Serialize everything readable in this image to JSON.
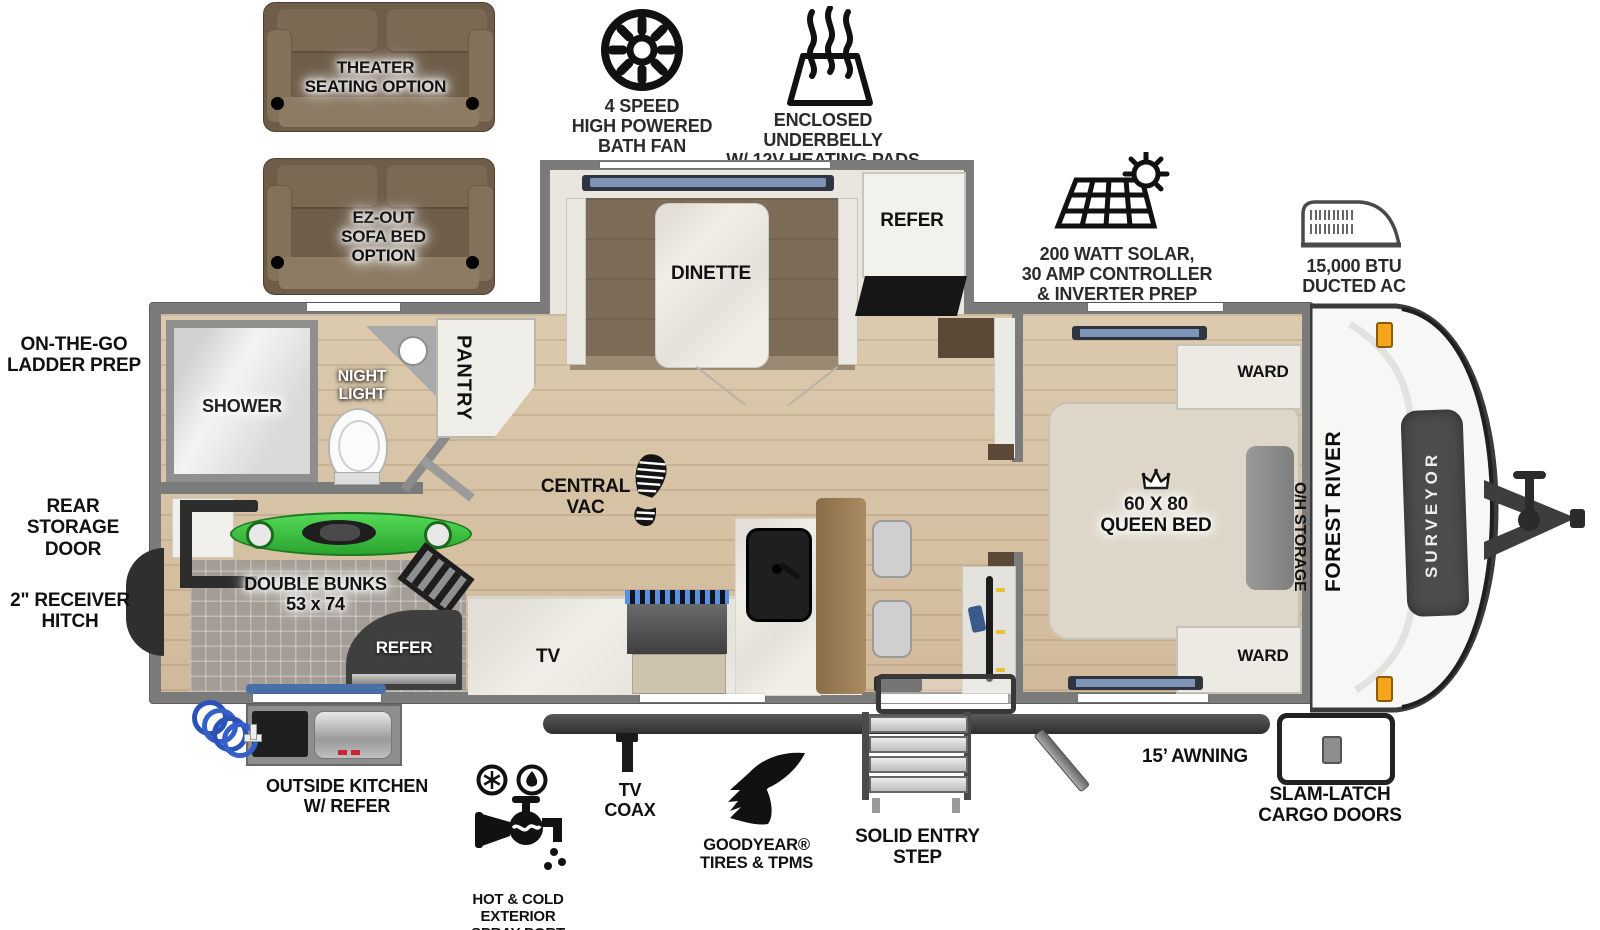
{
  "title": "Forest River Surveyor travel trailer floorplan",
  "options": {
    "theater_seating": "THEATER\nSEATING OPTION",
    "ez_out_sofa": "EZ-OUT\nSOFA BED\nOPTION"
  },
  "callouts": {
    "bath_fan": "4 SPEED\nHIGH POWERED\nBATH FAN",
    "underbelly": "ENCLOSED UNDERBELLY\nW/ 12V HEATING PADS",
    "solar": "200 WATT SOLAR,\n30 AMP CONTROLLER\n& INVERTER PREP",
    "ducted_ac": "15,000 BTU\nDUCTED AC",
    "ladder_prep": "ON-THE-GO\nLADDER PREP",
    "rear_storage_door": "REAR STORAGE\nDOOR",
    "receiver_hitch": "2\" RECEIVER\nHITCH",
    "outside_kitchen": "OUTSIDE KITCHEN\nW/ REFER",
    "spray_port": "HOT & COLD EXTERIOR\nSPRAY PORT",
    "tv_coax": "TV\nCOAX",
    "goodyear": "GOODYEAR®\nTIRES & TPMS",
    "entry_step": "SOLID ENTRY\nSTEP",
    "awning": "15’ AWNING",
    "cargo_doors": "SLAM-LATCH\nCARGO DOORS"
  },
  "interior": {
    "shower": "SHOWER",
    "night_light": "NIGHT\nLIGHT",
    "pantry": "PANTRY",
    "dinette": "DINETTE",
    "refer": "REFER",
    "central_vac": "CENTRAL\nVAC",
    "double_bunks": "DOUBLE BUNKS\n53 x 74",
    "bunk_refer": "REFER",
    "tv": "TV",
    "queen_bed": "60 X 80\nQUEEN BED",
    "ward_top": "WARD",
    "ward_bottom": "WARD",
    "oh_storage": "O/H STORAGE"
  },
  "brand": {
    "manufacturer": "FOREST RIVER",
    "model": "SURVEYOR"
  },
  "colors": {
    "wall": "#7b7b7b",
    "wood_floor": "#d7c2a5",
    "tile_floor": "#a39d95",
    "sofa_brown": "#6f5d4a",
    "kayak_green": "#3fc441",
    "marker_light_orange": "#f7a41d"
  }
}
